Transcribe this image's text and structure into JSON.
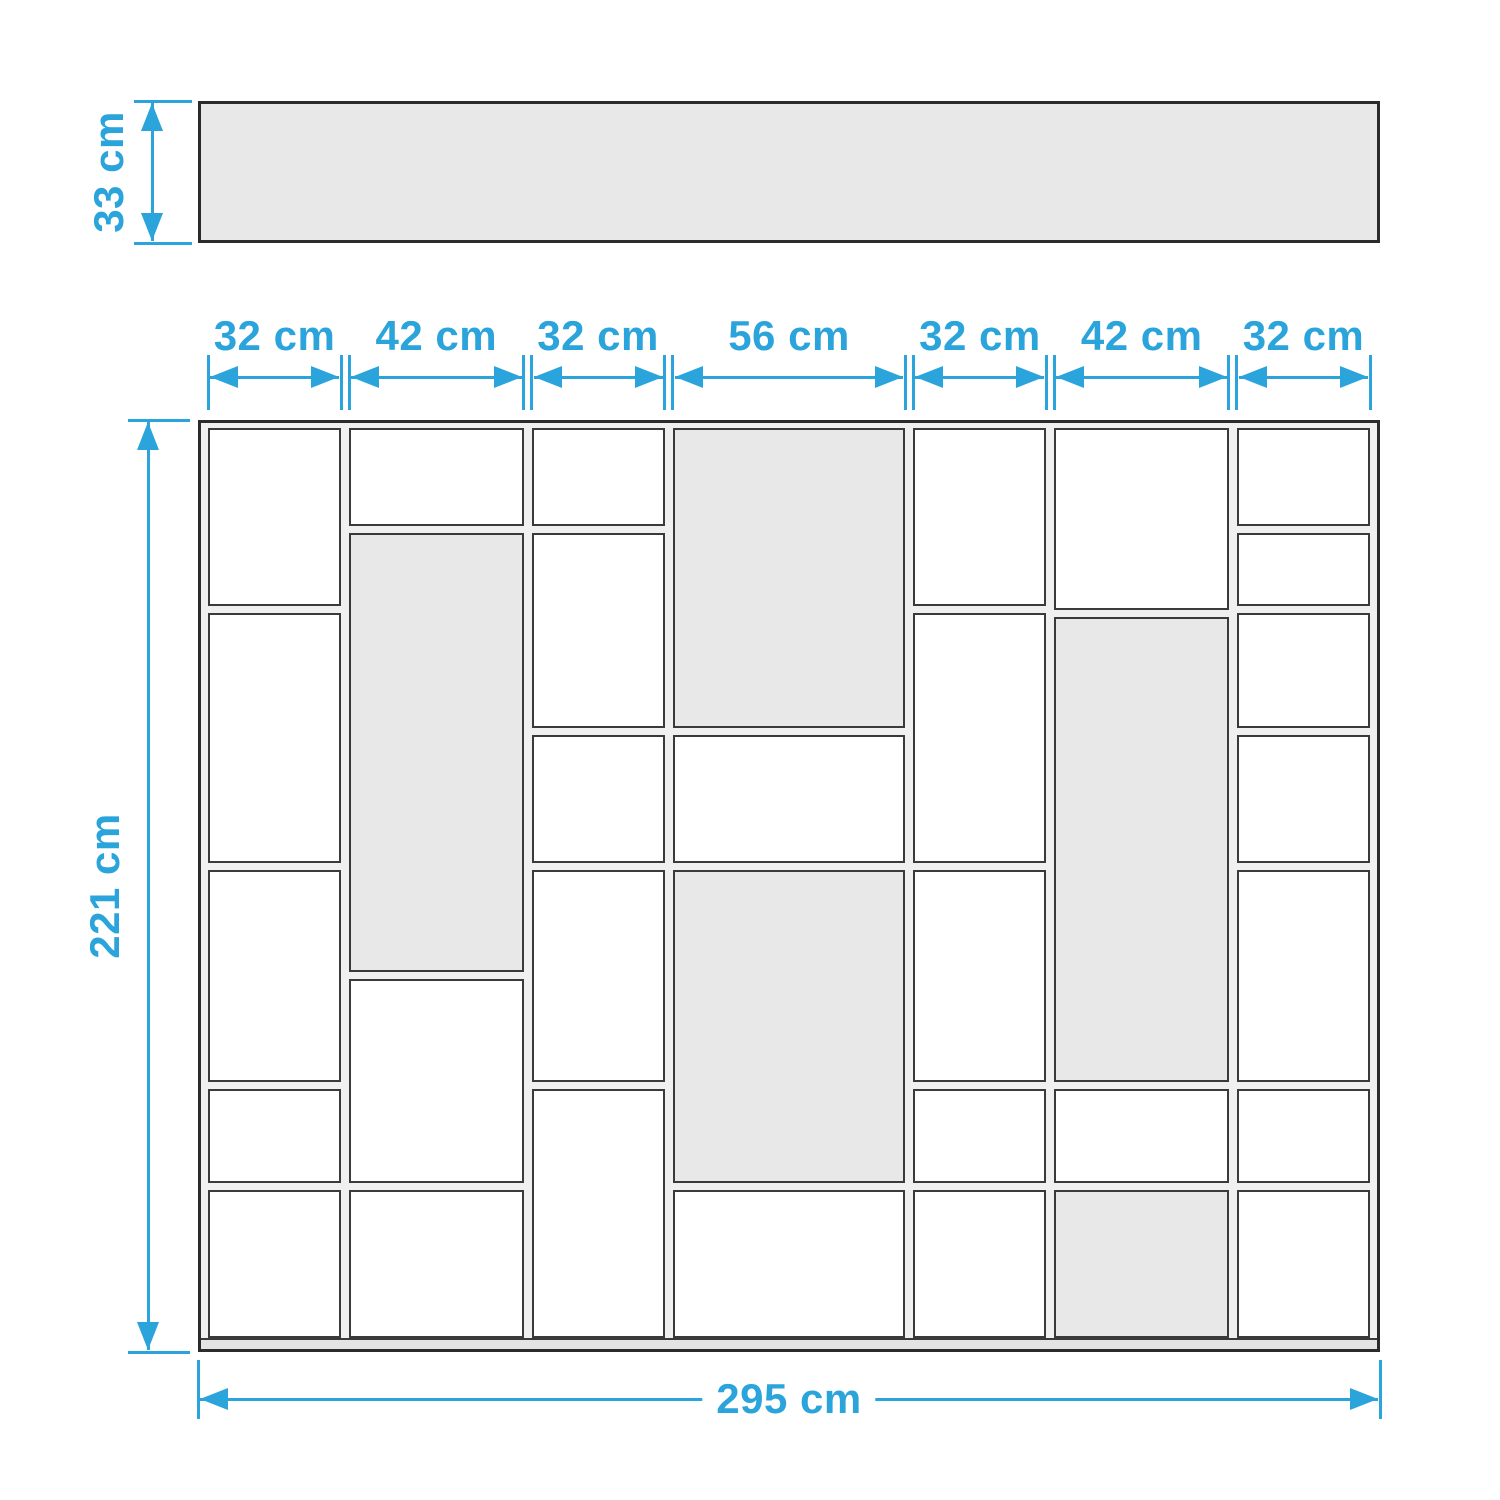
{
  "diagram": {
    "kind": "furniture-dimension-diagram",
    "unit": "cm"
  },
  "top_view": {
    "depth_label": "33 cm"
  },
  "front_view": {
    "total_width_label": "295 cm",
    "total_height_label": "221 cm",
    "column_width_labels": [
      "32 cm",
      "42 cm",
      "32 cm",
      "56 cm",
      "32 cm",
      "42 cm",
      "32 cm"
    ],
    "interior_height_cm": 216,
    "columns": [
      {
        "width_cm": 32,
        "cells": [
          {
            "h_cm": 43,
            "shaded": false
          },
          {
            "h_cm": 61,
            "shaded": false
          },
          {
            "h_cm": 52,
            "shaded": false
          },
          {
            "h_cm": 24,
            "shaded": false
          },
          {
            "h_cm": 36,
            "shaded": false
          }
        ]
      },
      {
        "width_cm": 42,
        "cells": [
          {
            "h_cm": 24,
            "shaded": false
          },
          {
            "h_cm": 106,
            "shaded": true
          },
          {
            "h_cm": 50,
            "shaded": false
          },
          {
            "h_cm": 36,
            "shaded": false
          }
        ]
      },
      {
        "width_cm": 32,
        "cells": [
          {
            "h_cm": 24,
            "shaded": false
          },
          {
            "h_cm": 48,
            "shaded": false
          },
          {
            "h_cm": 32,
            "shaded": false
          },
          {
            "h_cm": 52,
            "shaded": false
          },
          {
            "h_cm": 60,
            "shaded": false
          }
        ]
      },
      {
        "width_cm": 56,
        "cells": [
          {
            "h_cm": 72,
            "shaded": true
          },
          {
            "h_cm": 32,
            "shaded": false
          },
          {
            "h_cm": 76,
            "shaded": true
          },
          {
            "h_cm": 36,
            "shaded": false
          }
        ]
      },
      {
        "width_cm": 32,
        "cells": [
          {
            "h_cm": 43,
            "shaded": false
          },
          {
            "h_cm": 61,
            "shaded": false
          },
          {
            "h_cm": 52,
            "shaded": false
          },
          {
            "h_cm": 24,
            "shaded": false
          },
          {
            "h_cm": 36,
            "shaded": false
          }
        ]
      },
      {
        "width_cm": 42,
        "cells": [
          {
            "h_cm": 44,
            "shaded": false
          },
          {
            "h_cm": 112,
            "shaded": true
          },
          {
            "h_cm": 24,
            "shaded": false
          },
          {
            "h_cm": 36,
            "shaded": true
          }
        ]
      },
      {
        "width_cm": 32,
        "cells": [
          {
            "h_cm": 24,
            "shaded": false
          },
          {
            "h_cm": 19,
            "shaded": false
          },
          {
            "h_cm": 29,
            "shaded": false
          },
          {
            "h_cm": 32,
            "shaded": false
          },
          {
            "h_cm": 52,
            "shaded": false
          },
          {
            "h_cm": 24,
            "shaded": false
          },
          {
            "h_cm": 36,
            "shaded": false
          }
        ]
      }
    ]
  },
  "colors": {
    "accent": "#2AA4DB",
    "panel_gray": "#E8E8E8",
    "shelf_gray": "#F0F0F0",
    "line_dark": "#2B2B2B",
    "line_mid": "#3A3A3A"
  }
}
